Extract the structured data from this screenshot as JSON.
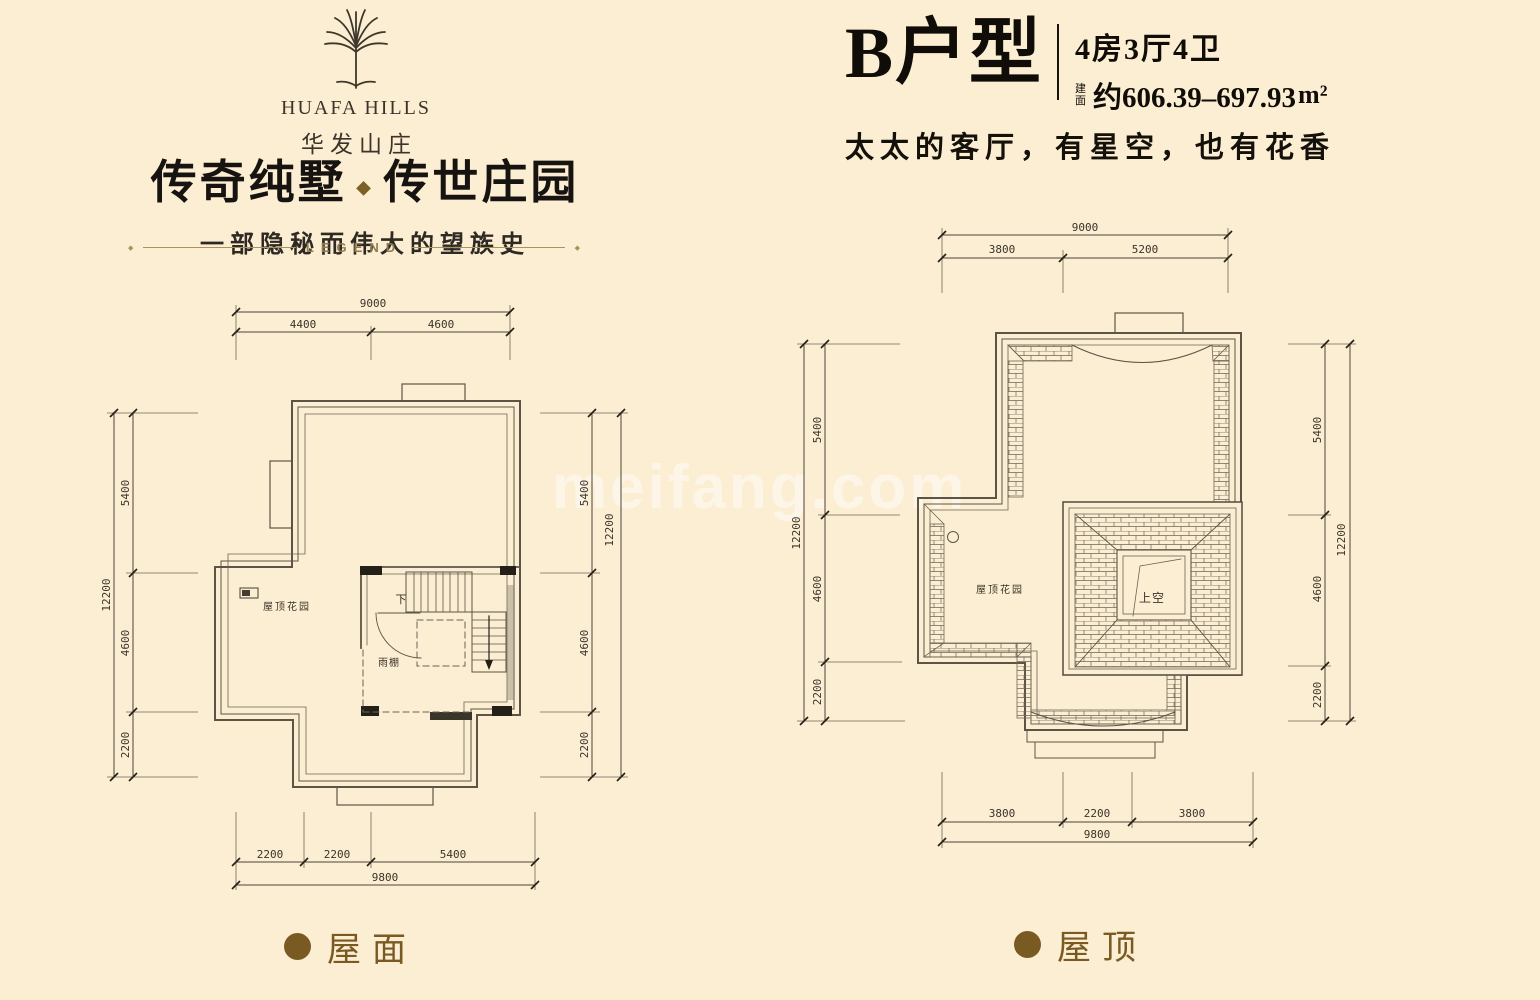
{
  "page": {
    "bg_color": "#fceed2"
  },
  "brand": {
    "name_en": "HUAFA HILLS",
    "name_cn": "华发山庄"
  },
  "slogan": {
    "left": "传奇纯墅",
    "right": "传世庄园",
    "ornament": "◆",
    "subtitle": "一部隐秘而伟大的望族史",
    "legend": "LEGEND",
    "end_ornament": "◆"
  },
  "unit": {
    "name": "B户型",
    "rooms": "4房3厅4卫",
    "area_label": "建面",
    "area_value": "约606.39–697.93",
    "area_unit": "m²",
    "tagline": "太太的客厅，有星空，也有花香"
  },
  "watermark": "meifang.com",
  "plans": {
    "left": {
      "caption": "屋面",
      "labels": {
        "garden": "屋顶花园",
        "canopy": "雨棚",
        "down": "下"
      },
      "dims": {
        "top_total": "9000",
        "top_segments": [
          "4400",
          "4600"
        ],
        "side_total": "12200",
        "side_segments": [
          "5400",
          "4600",
          "2200"
        ],
        "bottom_total": "9800",
        "bottom_segments": [
          "2200",
          "2200",
          "5400"
        ]
      }
    },
    "right": {
      "caption": "屋顶",
      "labels": {
        "garden": "屋顶花园",
        "void": "上空"
      },
      "dims": {
        "top_total": "9000",
        "top_segments": [
          "3800",
          "5200"
        ],
        "side_total": "12200",
        "side_segments": [
          "5400",
          "4600",
          "2200"
        ],
        "bottom_total": "9800",
        "bottom_segments": [
          "3800",
          "2200",
          "3800"
        ]
      }
    }
  },
  "colors": {
    "accent": "#7a5a23",
    "wall": "#5c5547",
    "dim_text": "#39332a",
    "tick": "#241f17"
  }
}
